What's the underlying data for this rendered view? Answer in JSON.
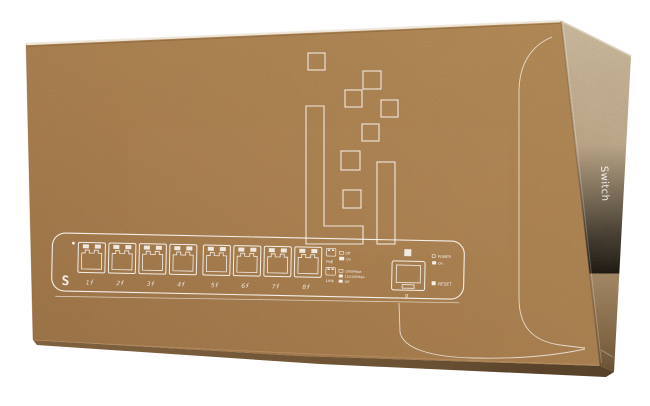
{
  "scene": {
    "background_color": "#ffffff",
    "cardboard_front_color": "#ab7d4b",
    "cardboard_side_color": "#c2ad90",
    "line_art_color": "#ffffff"
  },
  "side_panel": {
    "label": "Switch"
  },
  "switch_panel": {
    "logo": "S",
    "ports": [
      "1",
      "2",
      "3",
      "4",
      "5",
      "6",
      "7",
      "8"
    ],
    "sfp_label": "9",
    "poe_legend": {
      "title": "PoE",
      "rows": [
        "Off",
        "On"
      ]
    },
    "link_legend": {
      "title": "Link",
      "rows": [
        "1000Mbps",
        "10/100Mbps",
        "Off"
      ]
    },
    "power": {
      "label": "POWER",
      "state": "On"
    },
    "reset_label": "RESET"
  }
}
